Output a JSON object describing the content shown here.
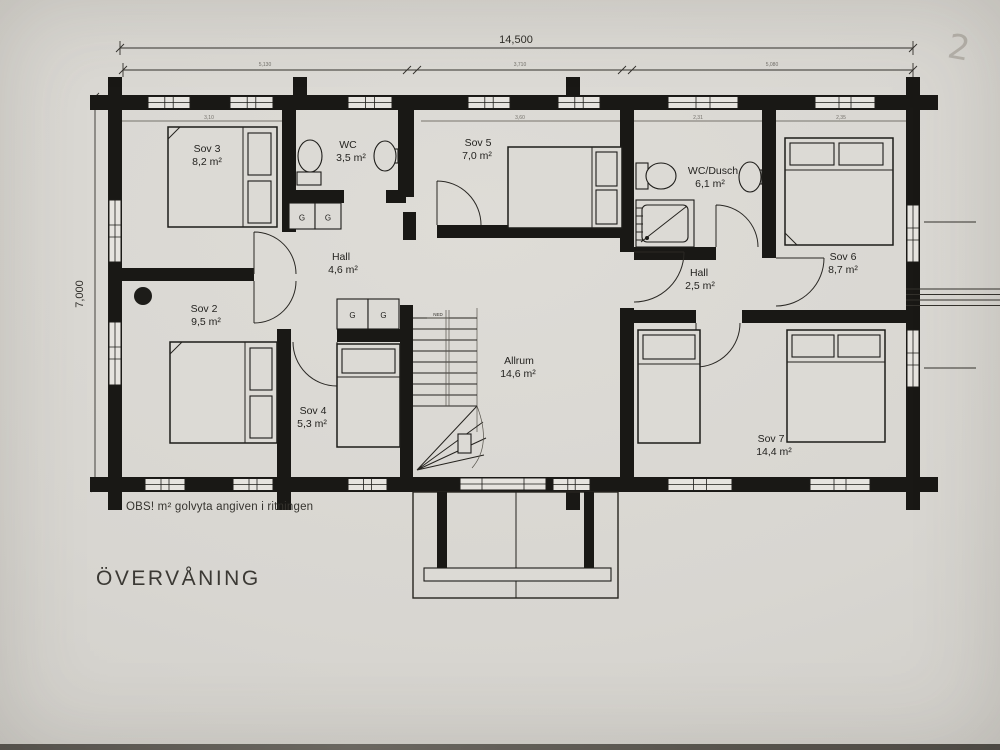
{
  "drawing": {
    "title": "ÖVERVÅNING",
    "note": "OBS! m² golvyta angiven i ritningen",
    "pencil_mark": "2",
    "stair_label": "NED",
    "wardrobe_label": "G"
  },
  "dimensions": {
    "total_width": "14,500",
    "total_height": "7,000",
    "width_segments": [
      "5,130",
      "3,710",
      "5,080"
    ],
    "interior_dims": [
      "3,10",
      "3,60",
      "2,31",
      "2,35"
    ]
  },
  "rooms": [
    {
      "name": "Sov 3",
      "area": "8,2 m²"
    },
    {
      "name": "WC",
      "area": "3,5 m²"
    },
    {
      "name": "Sov 5",
      "area": "7,0 m²"
    },
    {
      "name": "WC/Dusch",
      "area": "6,1 m²"
    },
    {
      "name": "Sov 6",
      "area": "8,7 m²"
    },
    {
      "name": "Hall",
      "area": "4,6 m²"
    },
    {
      "name": "Hall",
      "area": "2,5 m²"
    },
    {
      "name": "Sov 2",
      "area": "9,5 m²"
    },
    {
      "name": "Sov 4",
      "area": "5,3 m²"
    },
    {
      "name": "Allrum",
      "area": "14,6 m²"
    },
    {
      "name": "Sov 7",
      "area": "14,4 m²"
    }
  ]
}
